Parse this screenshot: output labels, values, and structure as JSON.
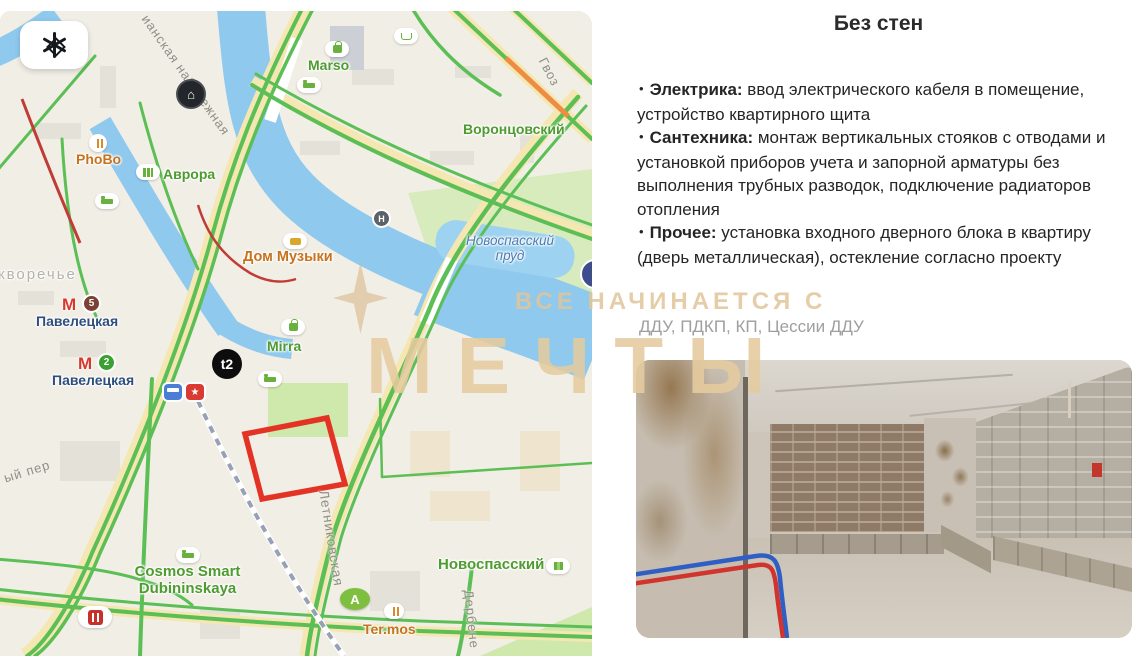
{
  "watermark": {
    "line1": "ВСЕ НАЧИНАЕТСЯ С",
    "line2": "МЕЧТЫ"
  },
  "map": {
    "metro_m": "М",
    "metro_stations": [
      {
        "line_number": "5",
        "line_color": "#7c4034",
        "name": "Павелецкая"
      },
      {
        "line_number": "2",
        "line_color": "#3aa132",
        "name": "Павелецкая"
      }
    ],
    "icons": {
      "star": "★",
      "house": "⌂",
      "helipad": "Н",
      "aeroexpress": "A"
    },
    "place_labels": {
      "marso": "Marso",
      "vorontsovsky": "Воронцовский",
      "phobo": "PhoBo",
      "avrora": "Аврора",
      "dom_muzyki": "Дом Музыки",
      "novospassky_prud_line1": "Новоспасский",
      "novospassky_prud_line2": "пруд",
      "mirra": "Mirra",
      "t2": "t2",
      "zamoskvorechye": "кворечье",
      "cosmos_line1": "Cosmos Smart",
      "cosmos_line2": "Dubininskaya",
      "termos": "Ter.mos",
      "novospassky_bc": "Новоспасский"
    },
    "street_labels": {
      "embankment": "ианская набережная",
      "gvozdev": "Гвоз",
      "letnikovskaya": "Летниковская",
      "derbenevskaya": "Дербене",
      "pereulok": "ый пер"
    }
  },
  "panel": {
    "title": "Без стен",
    "bullet_char": "•",
    "bullets": [
      {
        "term": "Электрика:",
        "text": " ввод электрического кабеля в помещение, устройство квартирного щита"
      },
      {
        "term": "Сантехника:",
        "text": " монтаж вертикальных стояков с отводами и установкой приборов учета и запорной арматуры без выполнения трубных разводок, подключение радиаторов отопления"
      },
      {
        "term": "Прочее:",
        "text": " установка входного дверного блока в квартиру (дверь металлическая), остекление согласно проекту"
      }
    ],
    "contracts": "ДДУ, ПДКП, КП, Цессии ДДУ"
  },
  "colors": {
    "plot_outline": "#e23325",
    "watermark": "#e7cda4",
    "road_green": "#5cbf56",
    "traffic_orange": "#ee8c42",
    "traffic_red": "#bf3d36",
    "water": "#8fc9ee"
  }
}
